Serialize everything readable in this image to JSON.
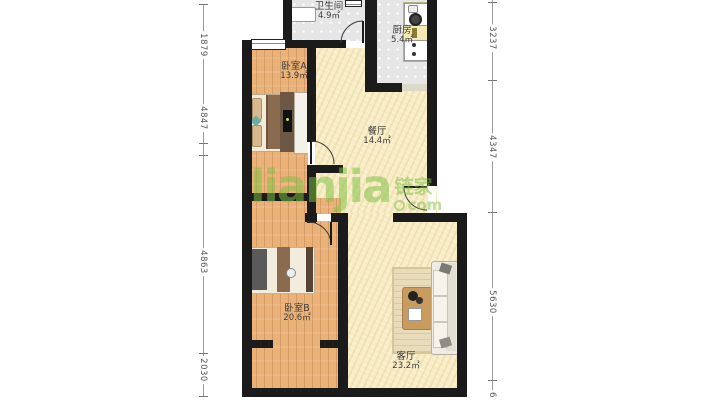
{
  "watermark": {
    "brand": "lianjia",
    "cjk": "链家",
    "domain": "com",
    "color": "#7cc143"
  },
  "rooms": [
    {
      "id": "bathroom",
      "name": "卫生间",
      "area": "4.9㎡",
      "cx": 329,
      "cy": 2
    },
    {
      "id": "kitchen",
      "name": "厨房",
      "area": "5.4㎡",
      "cx": 402,
      "cy": 26
    },
    {
      "id": "bedroom-a",
      "name": "卧室A",
      "area": "13.9㎡",
      "cx": 294,
      "cy": 62
    },
    {
      "id": "dining",
      "name": "餐厅",
      "area": "14.4㎡",
      "cx": 377,
      "cy": 127
    },
    {
      "id": "bedroom-b",
      "name": "卧室B",
      "area": "20.6㎡",
      "cx": 297,
      "cy": 304
    },
    {
      "id": "living",
      "name": "客厅",
      "area": "23.2㎡",
      "cx": 406,
      "cy": 352
    }
  ],
  "dimensions": {
    "left": [
      {
        "value": "1879",
        "y": 45
      },
      {
        "value": "4847",
        "y": 118
      },
      {
        "value": "4863",
        "y": 262
      },
      {
        "value": "2030",
        "y": 370
      }
    ],
    "right": [
      {
        "value": "3237",
        "y": 38
      },
      {
        "value": "4347",
        "y": 147
      },
      {
        "value": "5630",
        "y": 302
      },
      {
        "value": "6",
        "y": 395
      }
    ],
    "left_ticks": [
      4,
      143,
      155,
      353,
      365,
      396
    ],
    "right_ticks": [
      2,
      80,
      212,
      380
    ]
  },
  "colors": {
    "wall": "#1b1b1b",
    "wood": "#eab178",
    "cream": "#f8edc6",
    "tile": "#e6e6e6",
    "watermark_green": "#7cc143"
  }
}
